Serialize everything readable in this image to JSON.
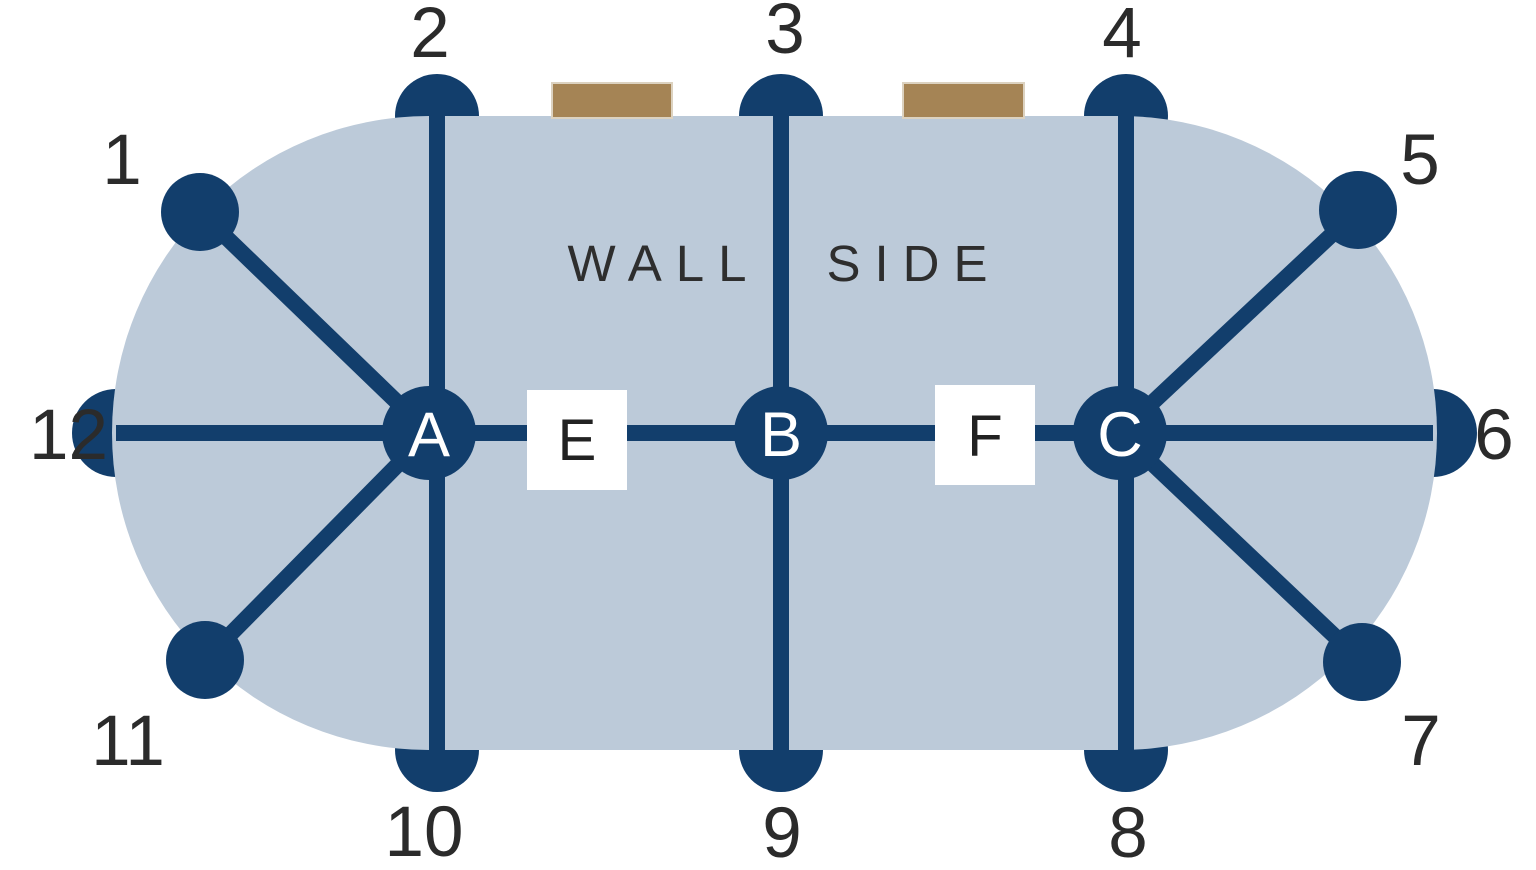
{
  "diagram": {
    "wall_side_label": {
      "left_word": "WALL",
      "right_word": "SIDE"
    },
    "seats": [
      {
        "number": "1"
      },
      {
        "number": "2"
      },
      {
        "number": "3"
      },
      {
        "number": "4"
      },
      {
        "number": "5"
      },
      {
        "number": "6"
      },
      {
        "number": "7"
      },
      {
        "number": "8"
      },
      {
        "number": "9"
      },
      {
        "number": "10"
      },
      {
        "number": "11"
      },
      {
        "number": "12"
      }
    ],
    "hubs": [
      {
        "label": "A"
      },
      {
        "label": "B"
      },
      {
        "label": "C"
      }
    ],
    "connectors": [
      {
        "label": "E"
      },
      {
        "label": "F"
      }
    ],
    "colors": {
      "background": "#ffffff",
      "table_fill": "#bccad9",
      "navy": "#123e6c",
      "marker_brown": "#a58455",
      "marker_border": "#dcd2c0",
      "label_text": "#2b2b2b",
      "hub_letter": "#ffffff",
      "connector_box": "#ffffff"
    }
  }
}
